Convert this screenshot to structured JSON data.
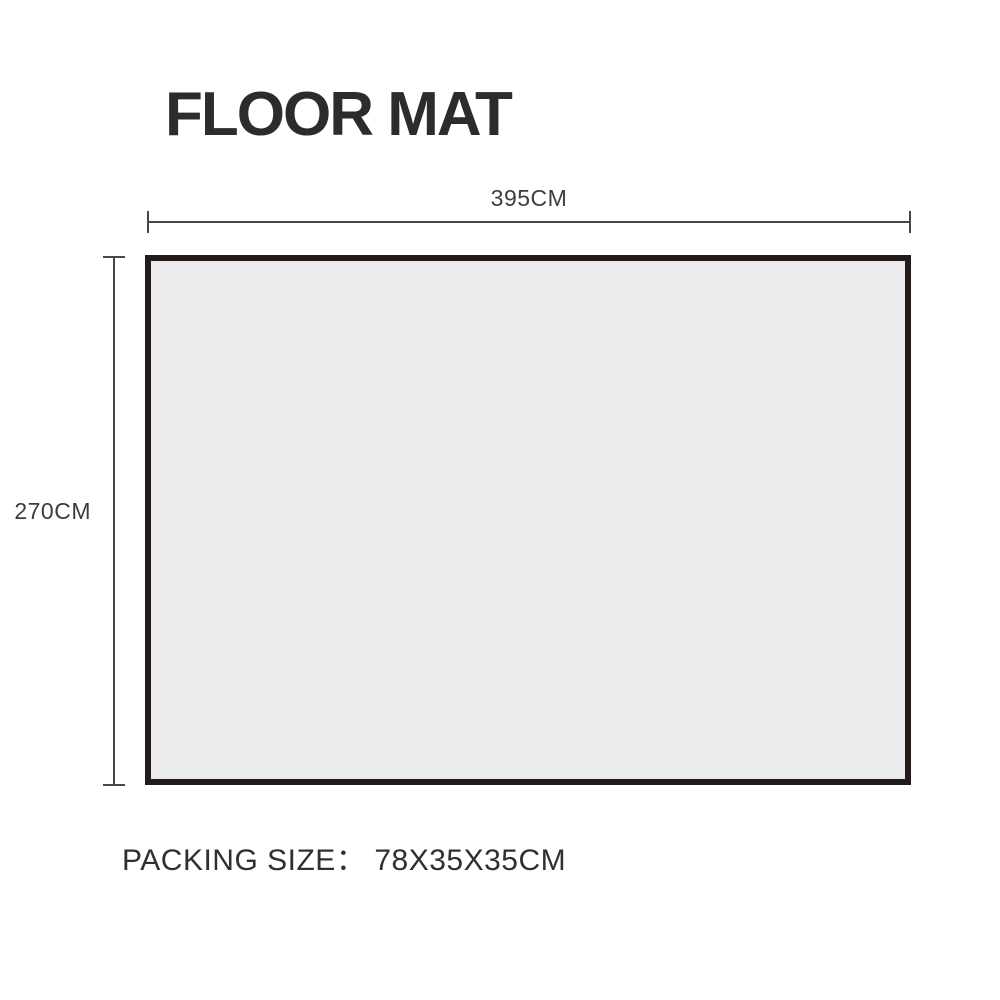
{
  "title": {
    "text": "FLOOR MAT"
  },
  "diagram": {
    "mat": {
      "description": "floor mat top view",
      "fill": "#ebebed",
      "border_color": "#231a1a"
    },
    "width_dimension": {
      "value": "395CM"
    },
    "height_dimension": {
      "value": "270CM"
    }
  },
  "packing": {
    "label": "PACKING SIZE：",
    "value": "78X35X35CM"
  },
  "colors": {
    "background": "#ffffff",
    "title_text": "#2d2b2c",
    "dimension_line": "#474747",
    "dimension_text": "#3d3d3d",
    "packing_text": "#303030"
  }
}
